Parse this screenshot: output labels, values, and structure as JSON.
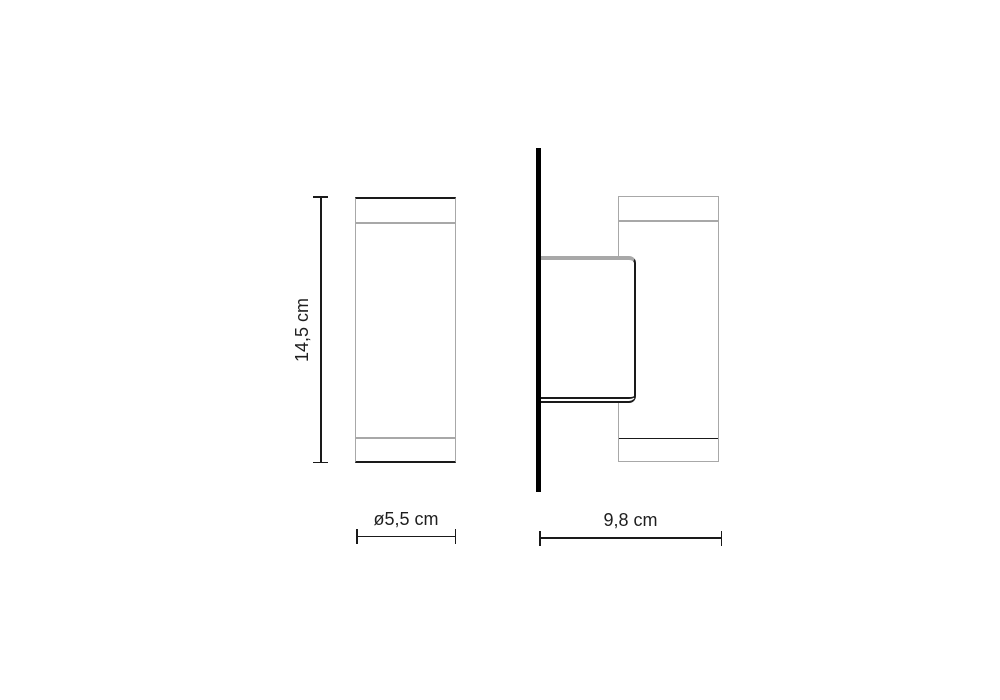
{
  "diagram": {
    "title": "Wall lamp dimension drawing",
    "views": {
      "front_view": {
        "name": "front view",
        "height_dimension": "14,5 cm",
        "diameter_dimension": "ø5,5 cm"
      },
      "side_view": {
        "name": "side view",
        "depth_dimension": "9,8 cm",
        "parts": [
          "wall",
          "mounting-bracket",
          "lamp-body"
        ]
      }
    },
    "colors": {
      "line_dark": "#1a1a1a",
      "line_gray": "#a8a8a8",
      "wall": "#000000",
      "text": "#1f1f1f",
      "background": "#ffffff"
    }
  }
}
